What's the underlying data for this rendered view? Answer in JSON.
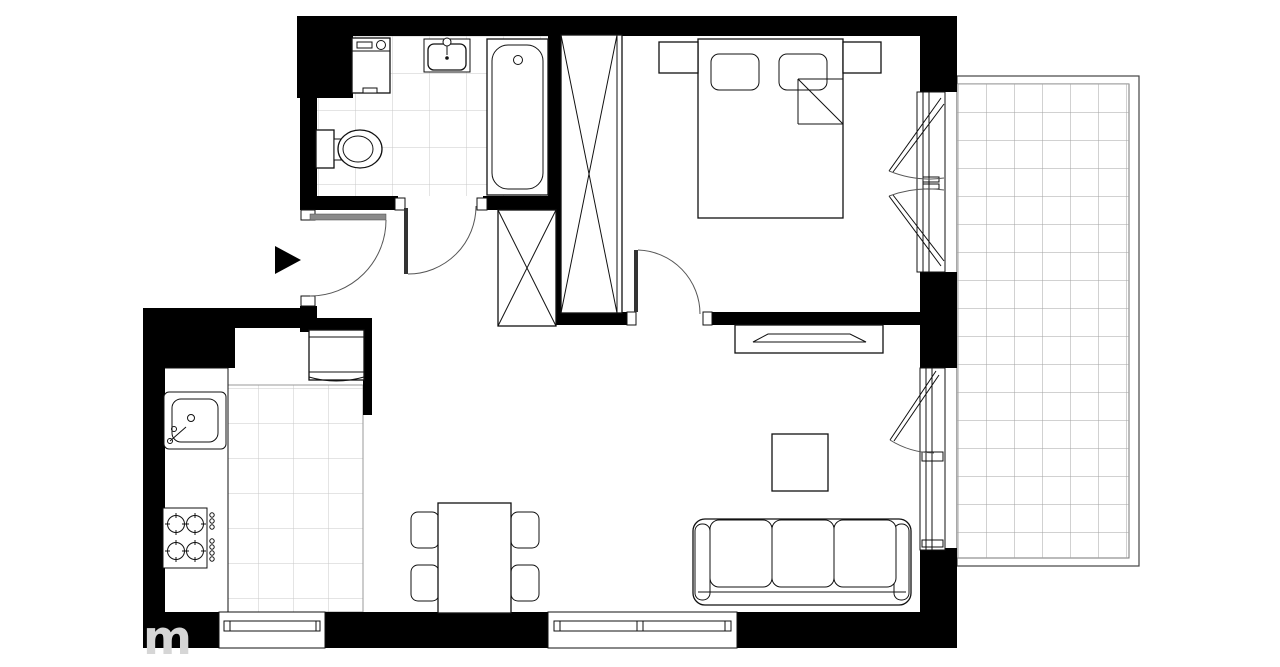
{
  "watermark": {
    "label": "m"
  },
  "colors": {
    "wall": "#000000",
    "background": "#ffffff",
    "tile_line": "#c9c9c9",
    "balcony_line": "#a3a3a3",
    "door_leaf": "#8a8a8a",
    "watermark": "#d6d6d6"
  },
  "plan": {
    "type": "apartment-floor-plan",
    "entrance_marker": "arrow-right",
    "rooms": [
      {
        "name": "bathroom",
        "features": [
          "washing-machine",
          "washbasin",
          "bathtub",
          "toilet",
          "tiled-floor",
          "door"
        ]
      },
      {
        "name": "hall",
        "features": [
          "entrance-door",
          "wardrobe"
        ]
      },
      {
        "name": "bedroom",
        "features": [
          "wardrobe",
          "double-bed",
          "pillows",
          "nightstand-left",
          "nightstand-right",
          "double-casement-window",
          "door"
        ]
      },
      {
        "name": "kitchen",
        "features": [
          "fridge",
          "countertop",
          "kitchen-sink",
          "cooktop-4-burners",
          "tiled-floor",
          "window"
        ]
      },
      {
        "name": "living-room",
        "features": [
          "tv-cabinet",
          "tv",
          "coffee-table",
          "sofa-3-seat",
          "dining-table",
          "four-chairs",
          "window",
          "balcony-door"
        ]
      },
      {
        "name": "balcony",
        "features": [
          "tiled-deck"
        ]
      }
    ]
  }
}
